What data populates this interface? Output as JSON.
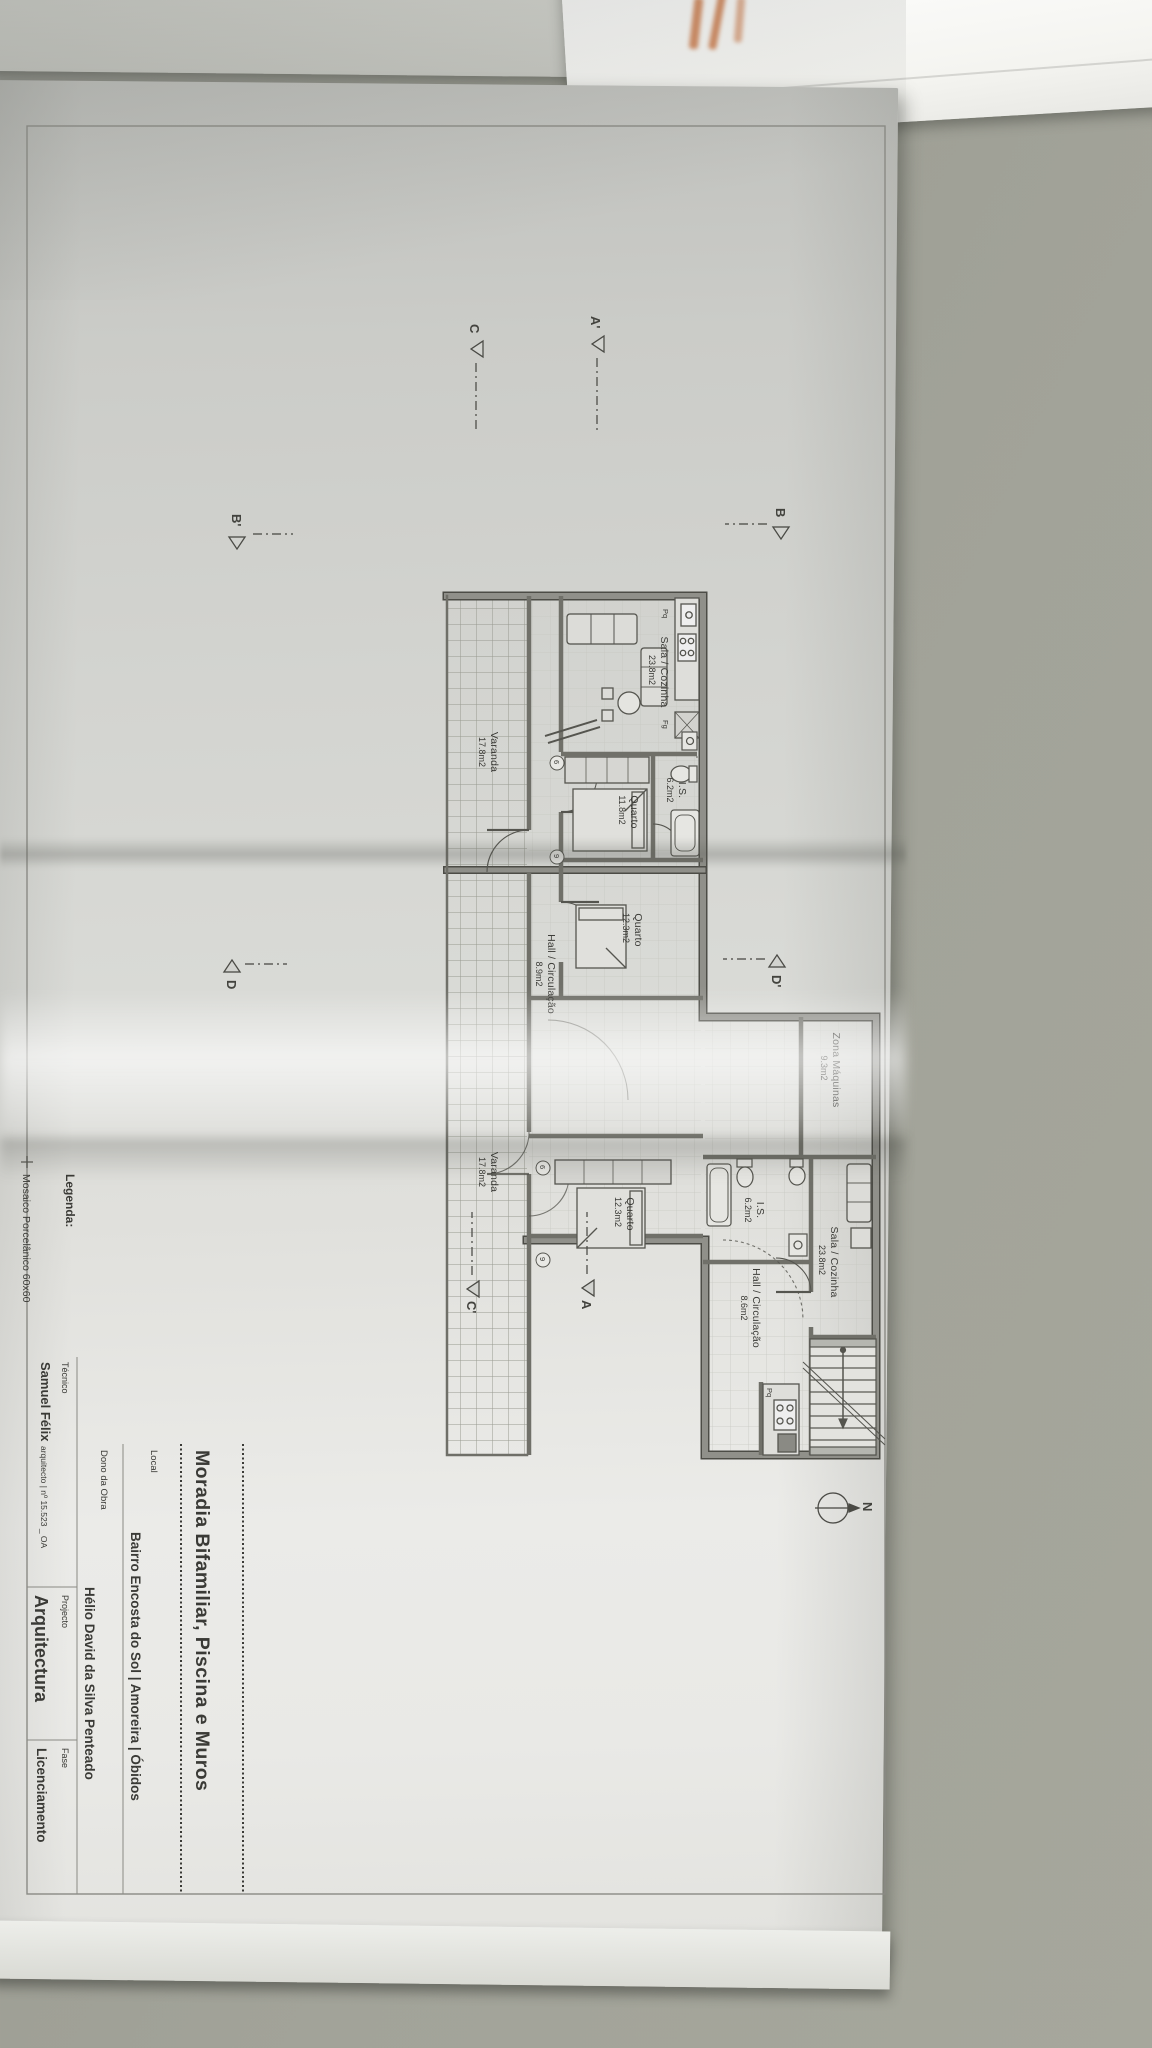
{
  "title_block": {
    "project_title": "Moradia Bifamiliar, Piscina e Muros",
    "fields": [
      {
        "label": "Local",
        "value": "Bairro Encosta do Sol | Amoreira | Óbidos"
      },
      {
        "label": "Dono da Obra",
        "value": "Hélio David da Silva Penteado"
      },
      {
        "label": "Técnico",
        "value": "Samuel Félix",
        "value_detail": "arquitecto | nº 15.523 _ OA"
      },
      {
        "label": "Projecto",
        "value": "Arquitectura"
      },
      {
        "label": "Fase",
        "value": "Licenciamento"
      }
    ]
  },
  "legend": {
    "title": "Legenda:",
    "items": [
      "Mosaico Porcelânico 60x60"
    ]
  },
  "floor_plan": {
    "units": [
      {
        "id": "unit-1",
        "rooms": [
          {
            "name": "Sala / Cozinha",
            "area": "23.8m2"
          },
          {
            "name": "Hall / Circulação",
            "area": "8.9m2"
          },
          {
            "name": "Quarto",
            "area": "11.8m2"
          },
          {
            "name": "Quarto",
            "area": "12.3m2"
          },
          {
            "name": "I.S.",
            "area": "6.2m2"
          },
          {
            "name": "Varanda",
            "area": "17.8m2"
          }
        ]
      },
      {
        "id": "unit-2",
        "rooms": [
          {
            "name": "Quarto",
            "area": "12.3m2"
          },
          {
            "name": "I.S.",
            "area": "6.2m2"
          },
          {
            "name": "Hall / Circulação",
            "area": "8.6m2"
          },
          {
            "name": "Sala / Cozinha",
            "area": "23.8m2"
          },
          {
            "name": "Varanda",
            "area": "17.8m2"
          }
        ]
      }
    ],
    "shared_rooms": [
      {
        "name": "Zona Máquinas",
        "area": "9.3m2"
      }
    ],
    "appliance_tags": [
      "Fg",
      "Pq"
    ],
    "window_tags": [
      "6",
      "9"
    ],
    "section_markers": [
      "A'",
      "C",
      "B",
      "B'",
      "D",
      "D'",
      "A",
      "C'"
    ],
    "north_label": "N"
  },
  "colors": {
    "paper": "#d8d9d5",
    "desk": "#9c9d93",
    "ink": "#3a3a36",
    "wall_grey": "#8f8f88",
    "orange_marks": "#c96f3a"
  }
}
